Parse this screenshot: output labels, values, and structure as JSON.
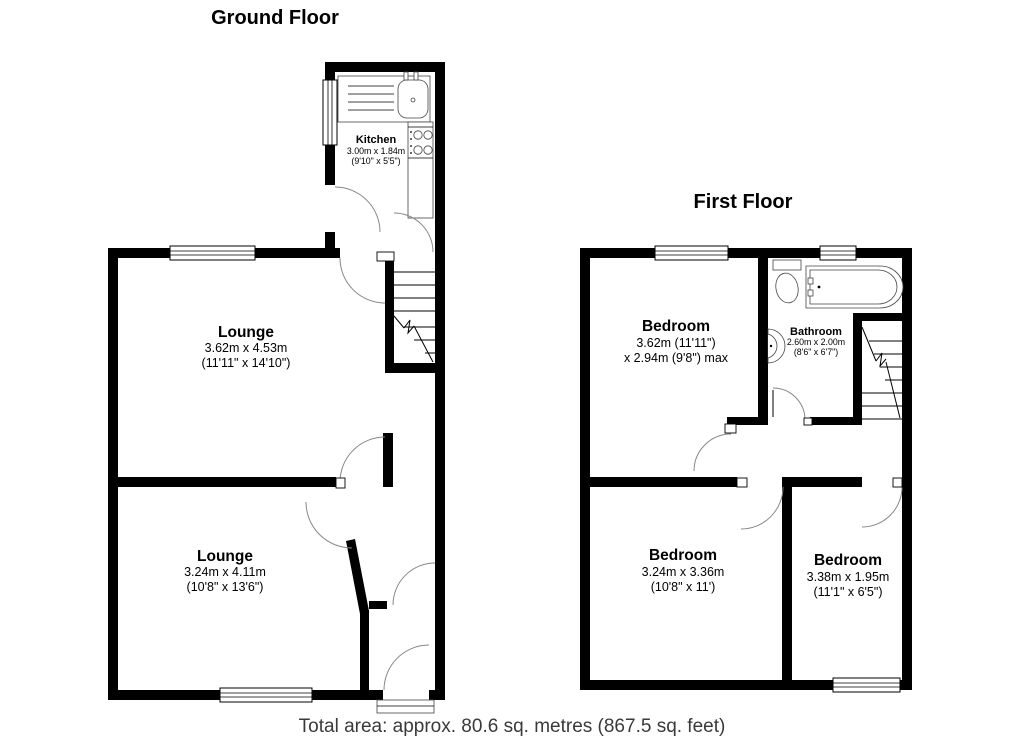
{
  "ground_floor": {
    "title": "Ground Floor",
    "rooms": {
      "kitchen": {
        "name": "Kitchen",
        "metric": "3.00m x 1.84m",
        "imperial": "(9'10\" x 5'5\")"
      },
      "lounge_top": {
        "name": "Lounge",
        "metric": "3.62m x 4.53m",
        "imperial": "(11'11\" x 14'10\")"
      },
      "lounge_bottom": {
        "name": "Lounge",
        "metric": "3.24m x 4.11m",
        "imperial": "(10'8\" x 13'6\")"
      }
    }
  },
  "first_floor": {
    "title": "First Floor",
    "rooms": {
      "bedroom_top": {
        "name": "Bedroom",
        "metric": "3.62m (11'11\")",
        "imperial": "x 2.94m (9'8\") max"
      },
      "bathroom": {
        "name": "Bathroom",
        "metric": "2.60m x 2.00m",
        "imperial": "(8'6\" x 6'7\")"
      },
      "bedroom_left": {
        "name": "Bedroom",
        "metric": "3.24m x 3.36m",
        "imperial": "(10'8\" x 11')"
      },
      "bedroom_right": {
        "name": "Bedroom",
        "metric": "3.38m x 1.95m",
        "imperial": "(11'1\" x 6'5\")"
      }
    }
  },
  "footer": {
    "total_area": "Total area: approx. 80.6 sq. metres (867.5 sq. feet)"
  },
  "colors": {
    "wall": "#000000",
    "door_arc": "#888888",
    "footer_text": "#3a3a3a",
    "background": "#ffffff"
  }
}
